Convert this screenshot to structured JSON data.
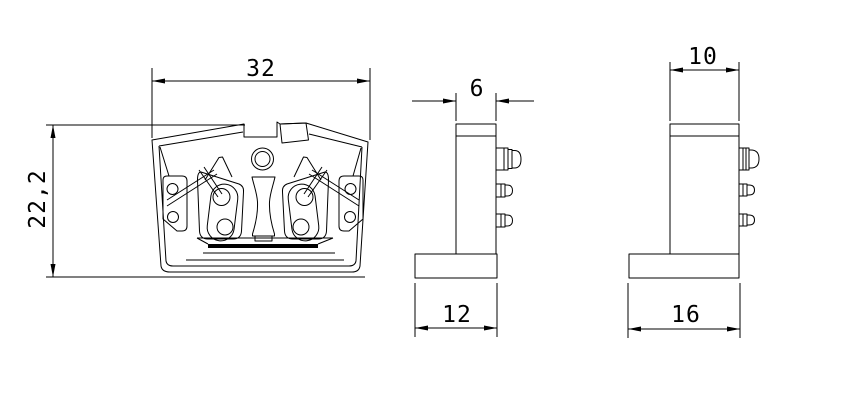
{
  "drawing": {
    "colors": {
      "line": "#000000",
      "background": "#ffffff"
    },
    "views": {
      "front": {
        "width": "32",
        "height": "22,2"
      },
      "side": {
        "top_width": "6",
        "base_width": "12"
      },
      "end": {
        "top_width": "10",
        "base_width": "16"
      }
    }
  }
}
